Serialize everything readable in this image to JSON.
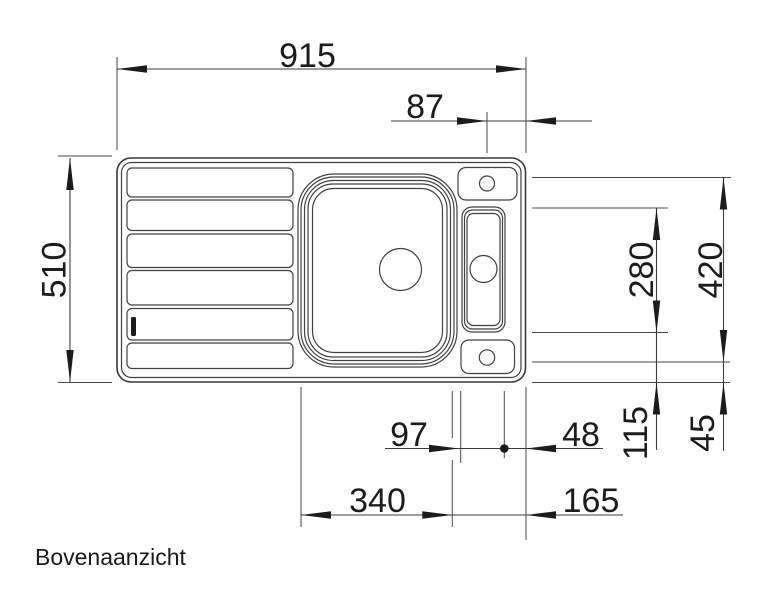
{
  "drawing": {
    "caption": "Bovenaanzicht",
    "view": "top",
    "colors": {
      "background": "#ffffff",
      "outline": "#3a3a3a",
      "dimension_lines": "#3c3c3c",
      "text": "#1c1c1c"
    },
    "dimensions": {
      "total_width": "915",
      "tap_offset_right": "87",
      "total_depth": "510",
      "remote_bowl_length": "280",
      "tap_span": "420",
      "main_bowl_width": "340",
      "right_section": "165",
      "remote_bowl_width": "97",
      "remote_to_edge": "48",
      "remote_to_front": "115",
      "span_to_front": "45"
    }
  }
}
